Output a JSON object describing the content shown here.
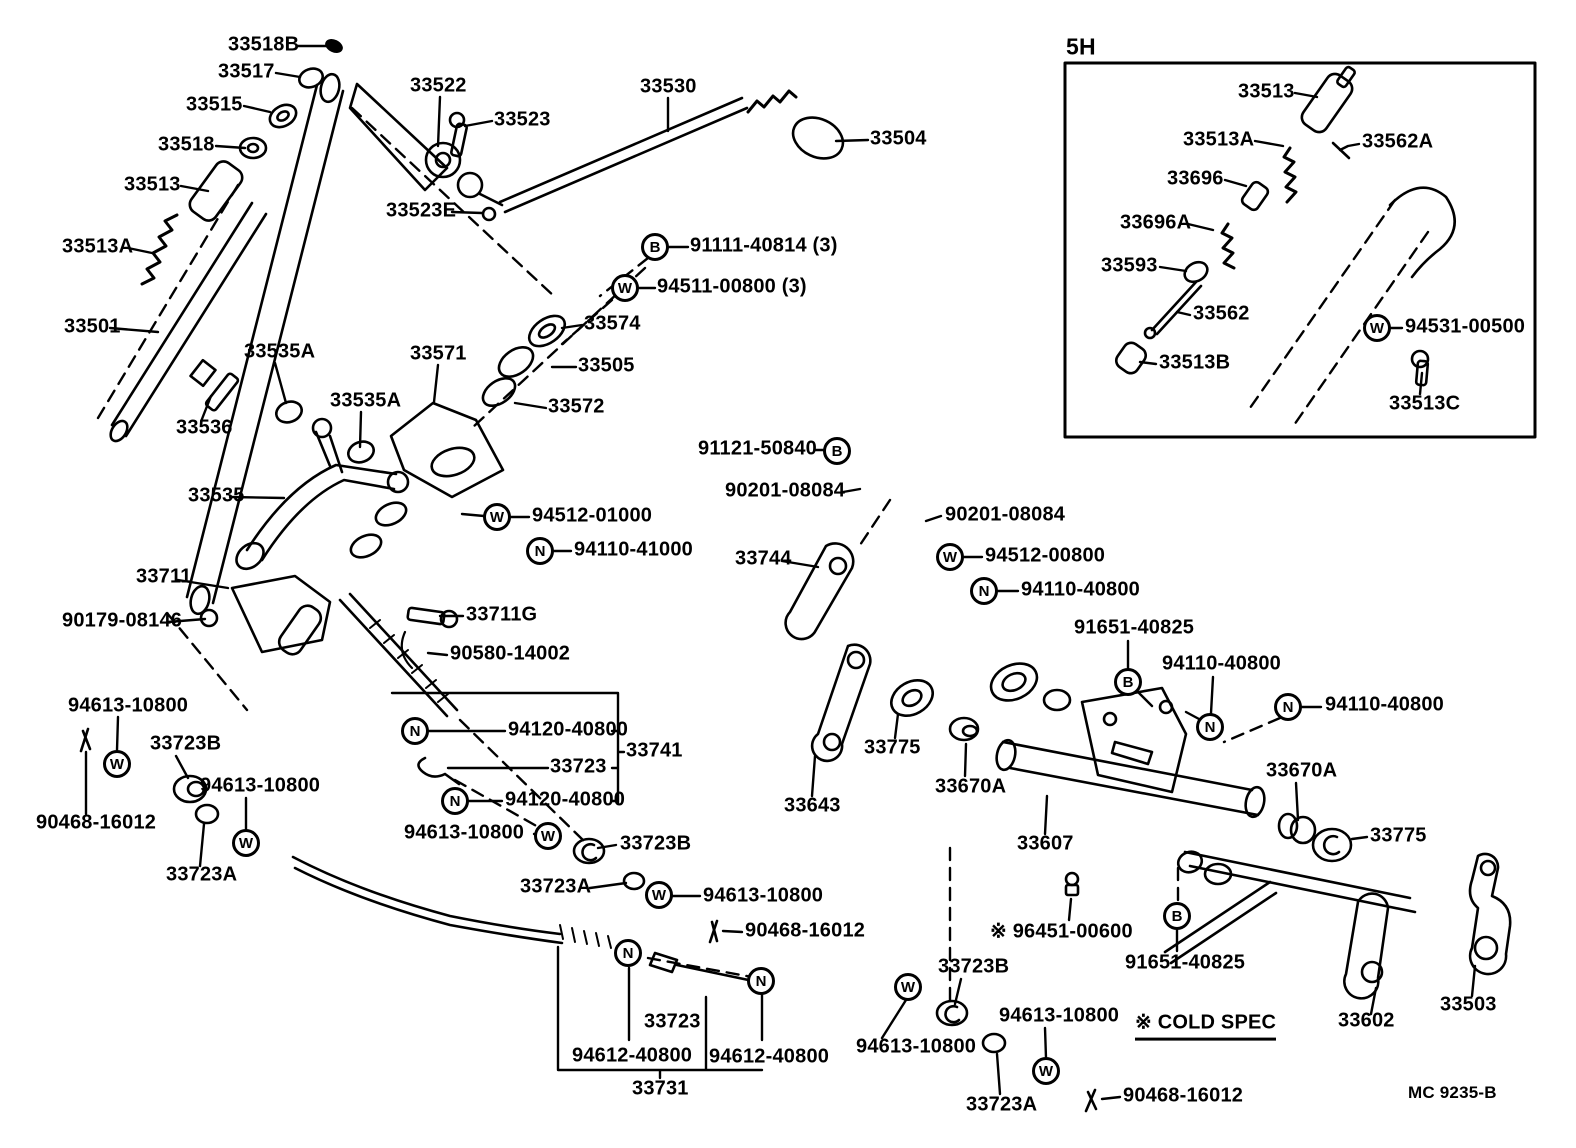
{
  "figure": {
    "inset_title": "5H",
    "cold_spec_note": "※ COLD SPEC",
    "drawing_code": "MC 9235-B"
  },
  "diagram": {
    "labels": [
      {
        "t": "33518B",
        "x": 228,
        "y": 46
      },
      {
        "t": "33517",
        "x": 218,
        "y": 73
      },
      {
        "t": "33515",
        "x": 186,
        "y": 106
      },
      {
        "t": "33518",
        "x": 158,
        "y": 146
      },
      {
        "t": "33513",
        "x": 124,
        "y": 186
      },
      {
        "t": "33513A",
        "x": 62,
        "y": 248
      },
      {
        "t": "33501",
        "x": 64,
        "y": 328
      },
      {
        "t": "33522",
        "x": 410,
        "y": 87
      },
      {
        "t": "33523",
        "x": 494,
        "y": 121
      },
      {
        "t": "33523E",
        "x": 386,
        "y": 212
      },
      {
        "t": "33530",
        "x": 640,
        "y": 88
      },
      {
        "t": "33504",
        "x": 870,
        "y": 140
      },
      {
        "t": "33536",
        "x": 176,
        "y": 429
      },
      {
        "t": "33535A",
        "x": 244,
        "y": 353
      },
      {
        "t": "33535A",
        "x": 330,
        "y": 402
      },
      {
        "t": "33571",
        "x": 410,
        "y": 355
      },
      {
        "t": "33574",
        "x": 584,
        "y": 325
      },
      {
        "t": "33505",
        "x": 578,
        "y": 367
      },
      {
        "t": "33572",
        "x": 548,
        "y": 408
      },
      {
        "t": "33535",
        "x": 188,
        "y": 497
      },
      {
        "t": "91111-40814 (3)",
        "x": 690,
        "y": 247
      },
      {
        "t": "94511-00800 (3)",
        "x": 657,
        "y": 288
      },
      {
        "t": "94512-01000",
        "x": 532,
        "y": 517
      },
      {
        "t": "94110-41000",
        "x": 574,
        "y": 551
      },
      {
        "t": "33711",
        "x": 136,
        "y": 578
      },
      {
        "t": "90179-08146",
        "x": 62,
        "y": 622
      },
      {
        "t": "33711G",
        "x": 466,
        "y": 616
      },
      {
        "t": "90580-14002",
        "x": 450,
        "y": 655
      },
      {
        "t": "94120-40800",
        "x": 508,
        "y": 731
      },
      {
        "t": "33723",
        "x": 550,
        "y": 768
      },
      {
        "t": "33741",
        "x": 626,
        "y": 752
      },
      {
        "t": "94120-40800",
        "x": 505,
        "y": 801
      },
      {
        "t": "94613-10800",
        "x": 404,
        "y": 834
      },
      {
        "t": "33723B",
        "x": 620,
        "y": 845
      },
      {
        "t": "94613-10800",
        "x": 68,
        "y": 707
      },
      {
        "t": "33723B",
        "x": 150,
        "y": 745
      },
      {
        "t": "94613-10800",
        "x": 200,
        "y": 787
      },
      {
        "t": "90468-16012",
        "x": 36,
        "y": 824
      },
      {
        "t": "33723A",
        "x": 166,
        "y": 876
      },
      {
        "t": "33723A",
        "x": 520,
        "y": 888
      },
      {
        "t": "94613-10800",
        "x": 703,
        "y": 897
      },
      {
        "t": "90468-16012",
        "x": 745,
        "y": 932
      },
      {
        "t": "33723",
        "x": 644,
        "y": 1023
      },
      {
        "t": "94612-40800",
        "x": 572,
        "y": 1057
      },
      {
        "t": "94612-40800",
        "x": 709,
        "y": 1058
      },
      {
        "t": "33731",
        "x": 632,
        "y": 1090
      },
      {
        "t": "91121-50840",
        "x": 698,
        "y": 450
      },
      {
        "t": "90201-08084",
        "x": 725,
        "y": 492
      },
      {
        "t": "90201-08084",
        "x": 945,
        "y": 516
      },
      {
        "t": "33744",
        "x": 735,
        "y": 560
      },
      {
        "t": "94512-00800",
        "x": 985,
        "y": 557
      },
      {
        "t": "94110-40800",
        "x": 1021,
        "y": 591
      },
      {
        "t": "91651-40825",
        "x": 1074,
        "y": 629
      },
      {
        "t": "94110-40800",
        "x": 1162,
        "y": 665
      },
      {
        "t": "94110-40800",
        "x": 1325,
        "y": 706
      },
      {
        "t": "33775",
        "x": 864,
        "y": 749
      },
      {
        "t": "33670A",
        "x": 935,
        "y": 788
      },
      {
        "t": "33643",
        "x": 784,
        "y": 807
      },
      {
        "t": "33607",
        "x": 1017,
        "y": 845
      },
      {
        "t": "※ 96451-00600",
        "x": 990,
        "y": 932
      },
      {
        "t": "91651-40825",
        "x": 1125,
        "y": 964
      },
      {
        "t": "33723B",
        "x": 938,
        "y": 968
      },
      {
        "t": "94613-10800",
        "x": 999,
        "y": 1017
      },
      {
        "t": "※ COLD SPEC",
        "x": 1135,
        "y": 1022,
        "u": true,
        "n": "cold-spec-note"
      },
      {
        "t": "94613-10800",
        "x": 856,
        "y": 1048
      },
      {
        "t": "33723A",
        "x": 966,
        "y": 1106
      },
      {
        "t": "90468-16012",
        "x": 1123,
        "y": 1097
      },
      {
        "t": "33670A",
        "x": 1266,
        "y": 772
      },
      {
        "t": "33775",
        "x": 1370,
        "y": 837
      },
      {
        "t": "33602",
        "x": 1338,
        "y": 1022
      },
      {
        "t": "33503",
        "x": 1440,
        "y": 1006
      },
      {
        "t": "MC  9235-B",
        "x": 1408,
        "y": 1094,
        "s": 17,
        "n": "drawing-code"
      },
      {
        "t": "5H",
        "x": 1066,
        "y": 48,
        "s": 23,
        "n": "inset-title"
      },
      {
        "t": "33513",
        "x": 1238,
        "y": 93
      },
      {
        "t": "33513A",
        "x": 1183,
        "y": 141
      },
      {
        "t": "33562A",
        "x": 1362,
        "y": 143
      },
      {
        "t": "33696",
        "x": 1167,
        "y": 180
      },
      {
        "t": "33696A",
        "x": 1120,
        "y": 224
      },
      {
        "t": "33593",
        "x": 1101,
        "y": 267
      },
      {
        "t": "33562",
        "x": 1193,
        "y": 315
      },
      {
        "t": "94531-00500",
        "x": 1405,
        "y": 328
      },
      {
        "t": "33513B",
        "x": 1159,
        "y": 364
      },
      {
        "t": "33513C",
        "x": 1389,
        "y": 405
      }
    ],
    "badges": [
      {
        "l": "B",
        "x": 655,
        "y": 247
      },
      {
        "l": "B",
        "x": 837,
        "y": 451
      },
      {
        "l": "B",
        "x": 1128,
        "y": 682
      },
      {
        "l": "B",
        "x": 1177,
        "y": 916
      },
      {
        "l": "W",
        "x": 625,
        "y": 288
      },
      {
        "l": "W",
        "x": 497,
        "y": 517
      },
      {
        "l": "W",
        "x": 548,
        "y": 836
      },
      {
        "l": "W",
        "x": 117,
        "y": 764
      },
      {
        "l": "W",
        "x": 246,
        "y": 843
      },
      {
        "l": "W",
        "x": 659,
        "y": 895
      },
      {
        "l": "W",
        "x": 950,
        "y": 557
      },
      {
        "l": "W",
        "x": 908,
        "y": 987
      },
      {
        "l": "W",
        "x": 1046,
        "y": 1071
      },
      {
        "l": "W",
        "x": 1377,
        "y": 328
      },
      {
        "l": "N",
        "x": 540,
        "y": 551
      },
      {
        "l": "N",
        "x": 415,
        "y": 731
      },
      {
        "l": "N",
        "x": 455,
        "y": 801
      },
      {
        "l": "N",
        "x": 628,
        "y": 953
      },
      {
        "l": "N",
        "x": 761,
        "y": 981
      },
      {
        "l": "N",
        "x": 984,
        "y": 591
      },
      {
        "l": "N",
        "x": 1210,
        "y": 727
      },
      {
        "l": "N",
        "x": 1288,
        "y": 707
      }
    ]
  }
}
